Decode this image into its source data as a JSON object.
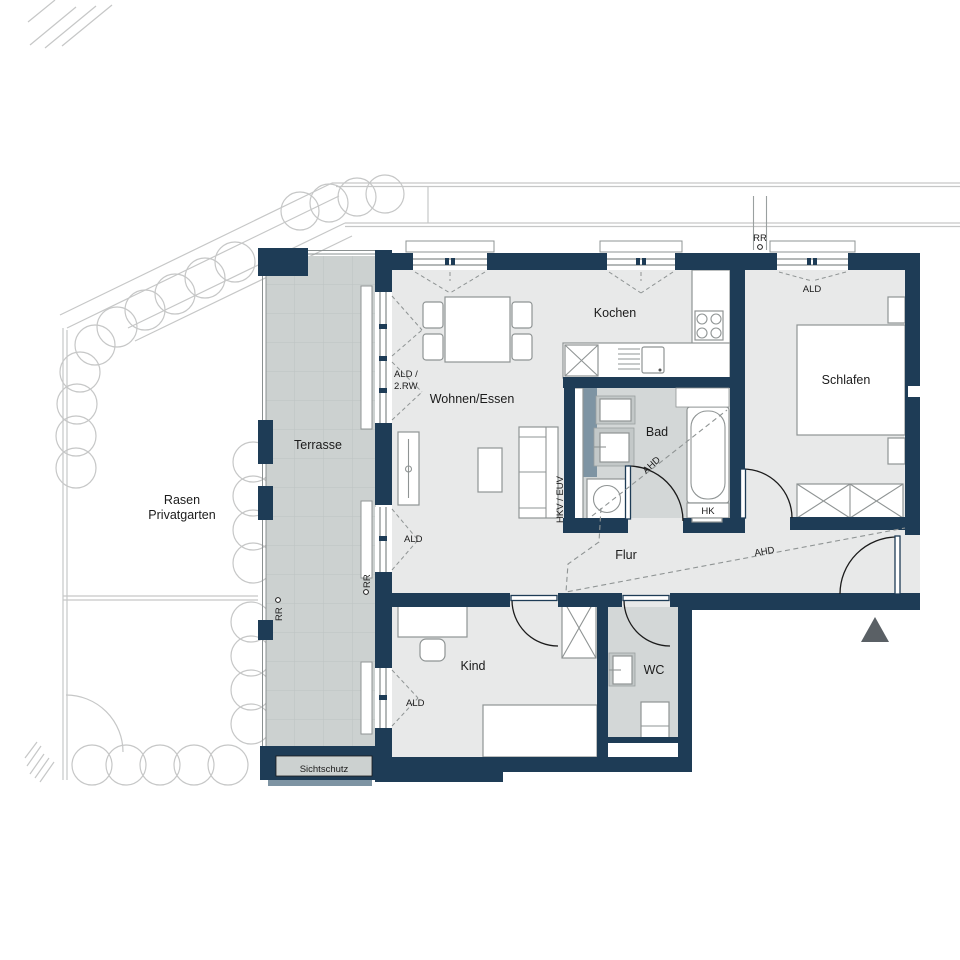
{
  "plan": {
    "title": "Wohnungsgrundriss",
    "rooms": {
      "terrasse": "Terrasse",
      "rasen_line1": "Rasen",
      "rasen_line2": "Privatgarten",
      "wohnen": "Wohnen/Essen",
      "kochen": "Kochen",
      "schlafen": "Schlafen",
      "bad": "Bad",
      "flur": "Flur",
      "kind": "Kind",
      "wc": "WC"
    },
    "annotations": {
      "ald": "ALD",
      "ald_combo_line1": "ALD /",
      "ald_combo_line2": "2.RW",
      "rr": "RR",
      "ahd": "AHD",
      "hk": "HK",
      "hkv_euv": "HKV / EUV",
      "sichtschutz": "Sichtschutz"
    },
    "colors": {
      "wall": "#1e3c56",
      "floor": "#e8e9e9",
      "wet": "#d3d7d7",
      "terrace": "#ccd1d0",
      "screen": "#7e94a3",
      "site": "#c6c7c7"
    }
  }
}
